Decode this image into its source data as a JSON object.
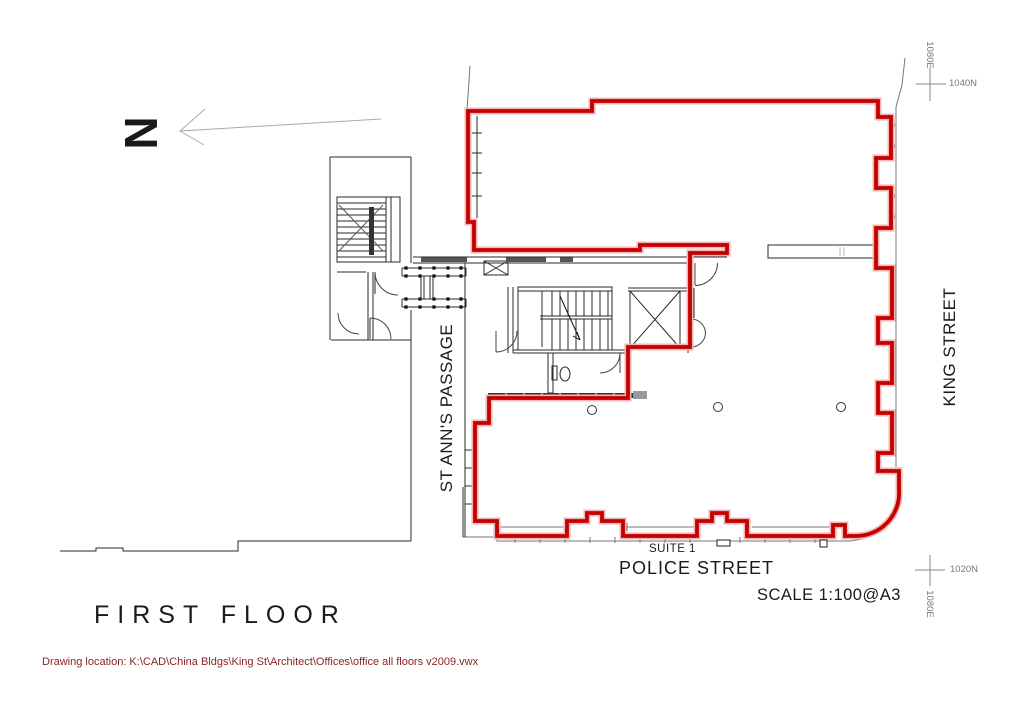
{
  "north_indicator": {
    "label": "N"
  },
  "labels": {
    "st_anns_passage": "ST ANN'S PASSAGE",
    "king_street": "KING STREET",
    "police_street": "POLICE STREET",
    "suite": "SUITE 1",
    "scale": "SCALE 1:100@A3",
    "floor_title": "FIRST FLOOR",
    "drawing_location": "Drawing location: K:\\CAD\\China Bldgs\\King St\\Architect\\Offices\\office all floors v2009.vwx"
  },
  "survey_markers": {
    "top_right": {
      "northing": "1040N",
      "easting": "1080E"
    },
    "bottom_right": {
      "northing": "1020N",
      "easting": "1080E"
    }
  },
  "colors": {
    "demise_line": "#c40000",
    "demise_halo": "#f0b4b4",
    "plan_lines": "#2a2a2a",
    "street_lines": "#777777",
    "survey_lines": "#888888",
    "drawing_location_text": "#8a2424"
  }
}
